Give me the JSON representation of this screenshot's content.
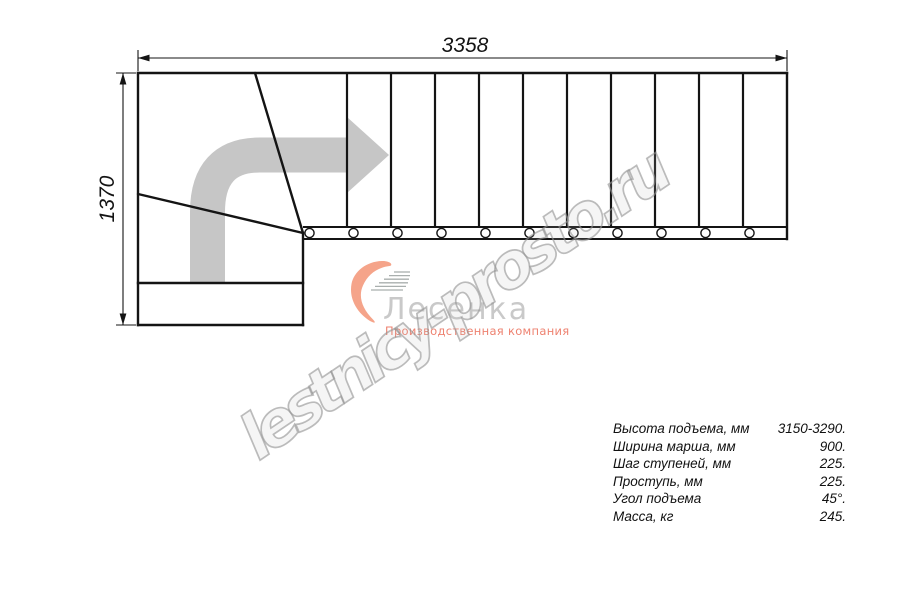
{
  "drawing": {
    "top_dimension": "3358",
    "left_dimension": "1370",
    "tread_count": 11
  },
  "logo": {
    "name": "Лесенка",
    "subtitle": "Производственная компания"
  },
  "watermark": {
    "text": "lestnicy-prosto.ru"
  },
  "specs": {
    "rows": [
      {
        "label": "Высота подъема, мм",
        "value": "3150-3290."
      },
      {
        "label": "Ширина марша, мм",
        "value": "900."
      },
      {
        "label": "Шаг ступеней, мм",
        "value": "225."
      },
      {
        "label": "Проступь, мм",
        "value": "225."
      },
      {
        "label": "Угол подъема",
        "value": "45°."
      },
      {
        "label": "Масса, кг",
        "value": "245."
      }
    ]
  },
  "colors": {
    "line": "#141414",
    "arrow": "#c6c6c6",
    "accent_salmon": "#ee8270",
    "logo_gray": "#c9c9c9",
    "watermark_gray": "#949494"
  }
}
